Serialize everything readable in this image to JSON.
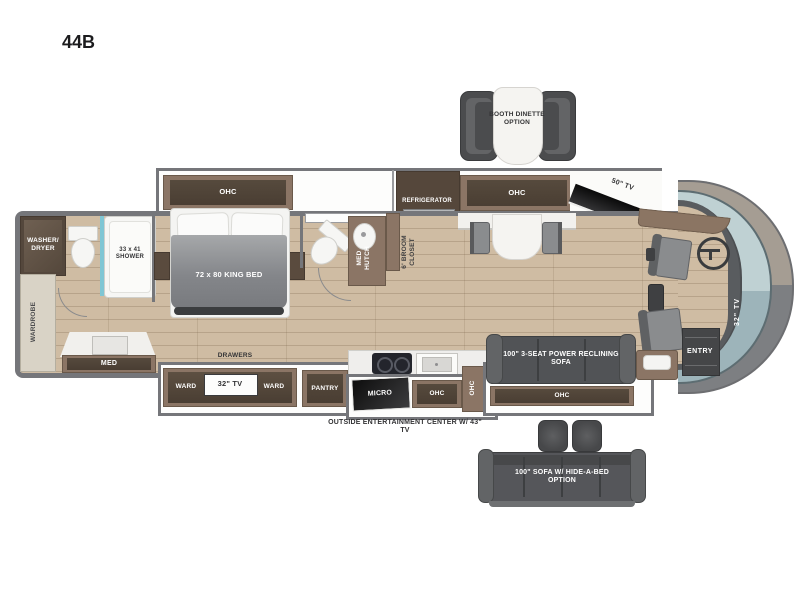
{
  "title": "44B",
  "options": {
    "booth": "BOOTH DINETTE OPTION",
    "hide_a_bed": "100\" SOFA W/ HIDE-A-BED OPTION"
  },
  "rear_bath": {
    "washer_dryer": "WASHER/ DRYER",
    "wardrobe": "WARDROBE",
    "shower": "33 x 41 SHOWER",
    "med": "MED"
  },
  "bedroom": {
    "ohc": "OHC",
    "bed": "72 x 80 KING BED",
    "drawers": "DRAWERS",
    "ward_left": "WARD",
    "tv": "32\" TV",
    "ward_right": "WARD"
  },
  "mid_bath": {
    "med_hutch": "MED HUTCH",
    "broom": "6' BROOM CLOSET"
  },
  "kitchen": {
    "refrigerator": "REFRIGERATOR",
    "ohc_upper": "OHC",
    "pantry": "PANTRY",
    "micro": "MICRO",
    "ohc_lower": "OHC",
    "ohc_side": "OHC",
    "outside_entertainment": "OUTSIDE ENTERTAINMENT CENTER W/ 43\" TV"
  },
  "living": {
    "tv": "50\" TV",
    "fireplace": "FIREPLACE",
    "sofa": "100\" 3-SEAT POWER RECLINING SOFA",
    "ohc": "OHC"
  },
  "front": {
    "tv": "32\" TV",
    "entry": "ENTRY"
  },
  "colors": {
    "floor": "#cfbca3",
    "wall": "#75767a",
    "cabinet": "#8b7565",
    "cabinet_dark": "#4a3e33",
    "seat": "#55565a",
    "windshield": "#b9cdd0",
    "counter": "#f2f1ee"
  }
}
